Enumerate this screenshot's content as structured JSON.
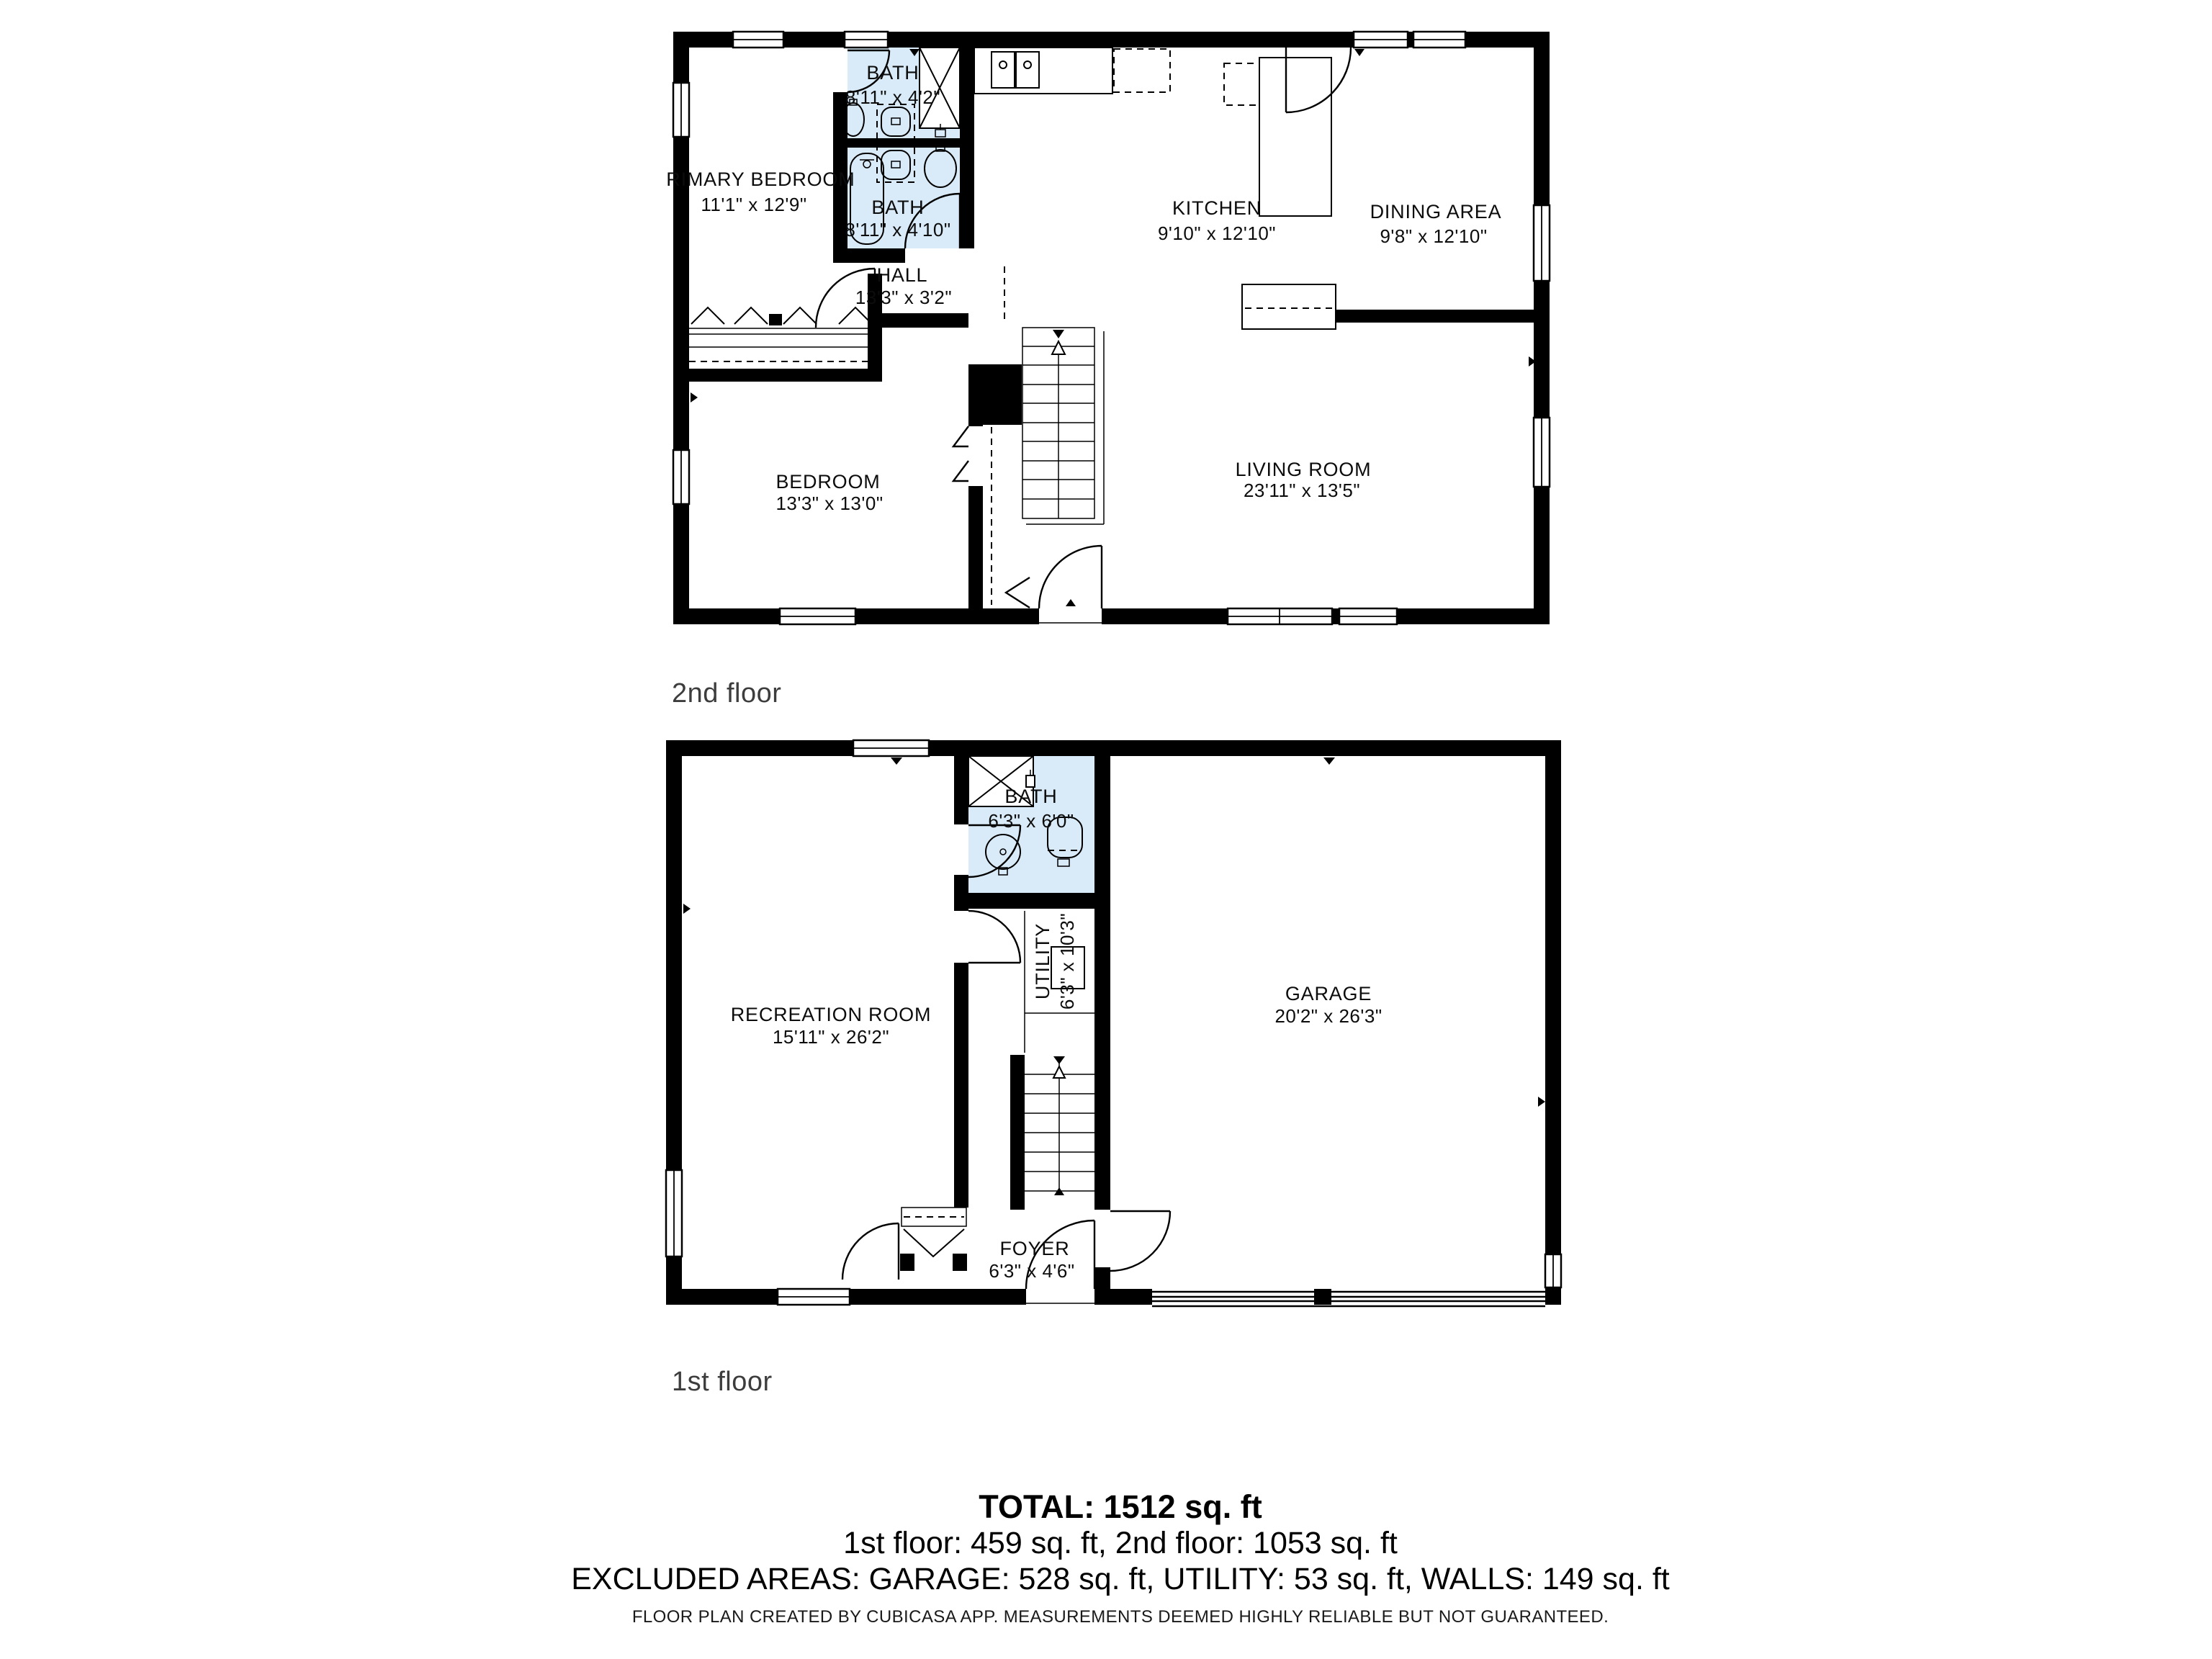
{
  "floor2": {
    "label": "2nd floor",
    "rooms": {
      "primary_bedroom": {
        "name": "PRIMARY BEDROOM",
        "dims": "11'1\" x 12'9\""
      },
      "bath_top": {
        "name": "BATH",
        "dims": "8'11\" x 4'2\""
      },
      "bath_main": {
        "name": "BATH",
        "dims": "8'11\" x 4'10\""
      },
      "kitchen": {
        "name": "KITCHEN",
        "dims": "9'10\" x 12'10\""
      },
      "dining": {
        "name": "DINING AREA",
        "dims": "9'8\" x 12'10\""
      },
      "hall": {
        "name": "HALL",
        "dims": "13'3\" x 3'2\""
      },
      "bedroom": {
        "name": "BEDROOM",
        "dims": "13'3\" x 13'0\""
      },
      "living": {
        "name": "LIVING ROOM",
        "dims": "23'11\" x 13'5\""
      }
    }
  },
  "floor1": {
    "label": "1st floor",
    "rooms": {
      "bath": {
        "name": "BATH",
        "dims": "6'3\" x 6'0\""
      },
      "utility": {
        "name": "UTILITY",
        "dims": "6'3\" x 10'3\""
      },
      "recreation": {
        "name": "RECREATION ROOM",
        "dims": "15'11\" x 26'2\""
      },
      "garage": {
        "name": "GARAGE",
        "dims": "20'2\" x 26'3\""
      },
      "foyer": {
        "name": "FOYER",
        "dims": "6'3\" x 4'6\""
      }
    }
  },
  "summary": {
    "total": "TOTAL: 1512 sq. ft",
    "floors_line": "1st floor: 459 sq. ft, 2nd floor: 1053 sq. ft",
    "excluded_line": "EXCLUDED AREAS: GARAGE: 528 sq. ft, UTILITY: 53 sq. ft, WALLS: 149 sq. ft",
    "disclaimer": "FLOOR PLAN CREATED BY CUBICASA APP. MEASUREMENTS DEEMED HIGHLY RELIABLE BUT NOT GUARANTEED."
  },
  "colors": {
    "wall": "#000000",
    "bath_fill": "#d9eaf8",
    "background": "#ffffff",
    "label_text": "#0c0c0c",
    "floor_label_text": "#3d3d3d"
  }
}
